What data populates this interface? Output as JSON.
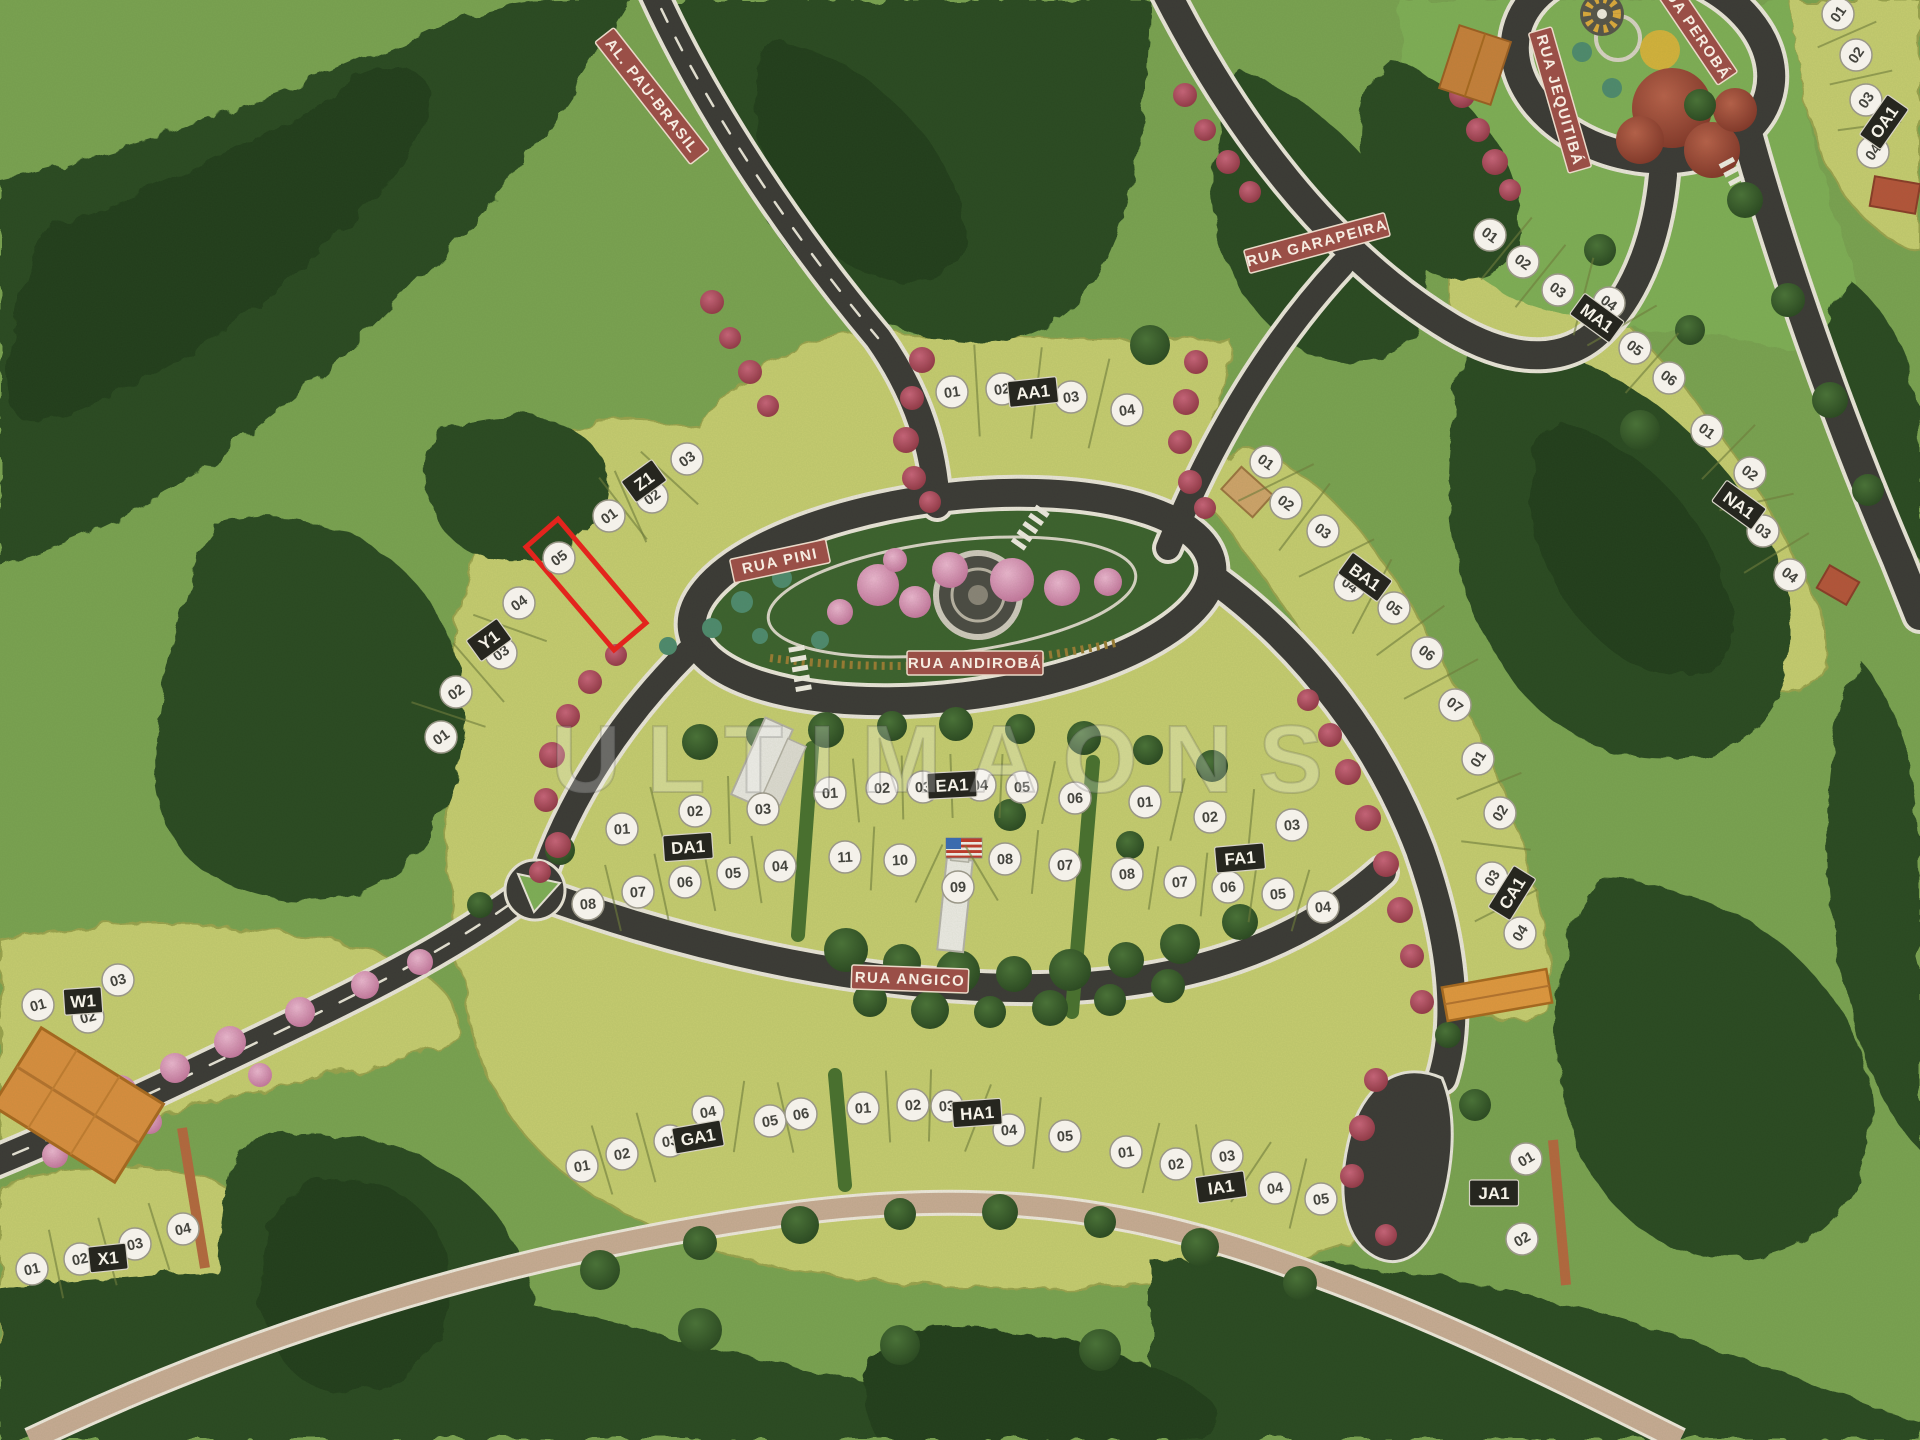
{
  "scene": {
    "description": "Aerial photograph of a physical scale model (maquette) of a residential land subdivision with forested terrain, named streets, numbered lots and one lot outlined in red",
    "width": 1920,
    "height": 1440
  },
  "watermark": {
    "text": "ULTIMAONS"
  },
  "palette": {
    "grass": "#7aa251",
    "lot_field": "#c6cc6f",
    "forest": "#2b4a22",
    "road": "#3b3936",
    "road_edge": "#eae5d9",
    "banner": "#9a4f47",
    "plaque": "#26261f",
    "badge": "#f4f1ea",
    "highlight": "#e3241d",
    "trail": "#c8ab94",
    "bougainvillea": "#b0475a",
    "pink_tree": "#d993b6",
    "autumn_tree": "#9c4433",
    "yellow_flower": "#d9ab3c"
  },
  "roads": [
    {
      "id": "al-pau-brasil",
      "label": "AL. PAU-BRASIL",
      "x": 652,
      "y": 96,
      "angle": 52
    },
    {
      "id": "rua-garapeira",
      "label": "RUA GARAPEIRA",
      "x": 1317,
      "y": 243,
      "angle": -15
    },
    {
      "id": "rua-jequitiba",
      "label": "RUA JEQUITIBÁ",
      "x": 1560,
      "y": 100,
      "angle": 74
    },
    {
      "id": "rua-peroba",
      "label": "RUA PEROBÁ",
      "x": 1695,
      "y": 30,
      "angle": 56
    },
    {
      "id": "rua-pini",
      "label": "RUA PINI",
      "x": 780,
      "y": 561,
      "angle": -12
    },
    {
      "id": "rua-andiroba",
      "label": "RUA ANDIROBÁ",
      "x": 975,
      "y": 663,
      "angle": 0
    },
    {
      "id": "rua-angico",
      "label": "RUA ANGICO",
      "x": 910,
      "y": 979,
      "angle": 2
    }
  ],
  "highlight": {
    "block": "Z1",
    "lot": "05",
    "points": "558,519 646,623 614,650 526,547"
  },
  "blocks": [
    {
      "label": "Z1",
      "plaque": {
        "x": 644,
        "y": 481,
        "angle": -36
      },
      "badge_angle": -36,
      "dividers": true,
      "divider_len": 78,
      "row_breaks": [],
      "lots": [
        {
          "n": "01",
          "x": 609,
          "y": 516
        },
        {
          "n": "02",
          "x": 652,
          "y": 497
        },
        {
          "n": "03",
          "x": 687,
          "y": 459
        },
        {
          "n": "05",
          "x": 559,
          "y": 558
        }
      ]
    },
    {
      "label": "Y1",
      "plaque": {
        "x": 489,
        "y": 640,
        "angle": -36
      },
      "badge_angle": -36,
      "dividers": true,
      "divider_len": 78,
      "row_breaks": [],
      "lots": [
        {
          "n": "01",
          "x": 441,
          "y": 737
        },
        {
          "n": "02",
          "x": 456,
          "y": 692
        },
        {
          "n": "03",
          "x": 501,
          "y": 653
        },
        {
          "n": "04",
          "x": 519,
          "y": 603
        }
      ]
    },
    {
      "label": "W1",
      "plaque": {
        "x": 83,
        "y": 1001,
        "angle": -4
      },
      "badge_angle": -15,
      "dividers": false,
      "divider_len": 60,
      "row_breaks": [],
      "lots": [
        {
          "n": "01",
          "x": 38,
          "y": 1005
        },
        {
          "n": "02",
          "x": 88,
          "y": 1017
        },
        {
          "n": "03",
          "x": 118,
          "y": 980
        }
      ]
    },
    {
      "label": "X1",
      "plaque": {
        "x": 108,
        "y": 1258,
        "angle": -6
      },
      "badge_angle": -12,
      "dividers": true,
      "divider_len": 70,
      "row_breaks": [],
      "lots": [
        {
          "n": "01",
          "x": 32,
          "y": 1269
        },
        {
          "n": "02",
          "x": 80,
          "y": 1259
        },
        {
          "n": "03",
          "x": 135,
          "y": 1244
        },
        {
          "n": "04",
          "x": 183,
          "y": 1229
        }
      ]
    },
    {
      "label": "AA1",
      "plaque": {
        "x": 1033,
        "y": 392,
        "angle": -6
      },
      "badge_angle": -8,
      "dividers": true,
      "divider_len": 92,
      "row_breaks": [],
      "lots": [
        {
          "n": "01",
          "x": 952,
          "y": 392
        },
        {
          "n": "02",
          "x": 1002,
          "y": 389
        },
        {
          "n": "03",
          "x": 1071,
          "y": 397
        },
        {
          "n": "04",
          "x": 1127,
          "y": 410
        }
      ]
    },
    {
      "label": "BA1",
      "plaque": {
        "x": 1365,
        "y": 577,
        "angle": 36
      },
      "badge_angle": 36,
      "dividers": true,
      "divider_len": 84,
      "row_breaks": [],
      "lots": [
        {
          "n": "01",
          "x": 1266,
          "y": 462
        },
        {
          "n": "02",
          "x": 1286,
          "y": 503
        },
        {
          "n": "03",
          "x": 1323,
          "y": 531
        },
        {
          "n": "04",
          "x": 1350,
          "y": 585
        },
        {
          "n": "05",
          "x": 1394,
          "y": 608
        },
        {
          "n": "06",
          "x": 1427,
          "y": 653
        },
        {
          "n": "07",
          "x": 1455,
          "y": 705
        }
      ]
    },
    {
      "label": "CA1",
      "plaque": {
        "x": 1512,
        "y": 893,
        "angle": -58
      },
      "badge_angle": -58,
      "dividers": true,
      "divider_len": 70,
      "row_breaks": [],
      "lots": [
        {
          "n": "01",
          "x": 1478,
          "y": 759
        },
        {
          "n": "02",
          "x": 1500,
          "y": 813
        },
        {
          "n": "03",
          "x": 1492,
          "y": 878
        },
        {
          "n": "04",
          "x": 1520,
          "y": 933
        }
      ]
    },
    {
      "label": "DA1",
      "plaque": {
        "x": 688,
        "y": 847,
        "angle": -4
      },
      "badge_angle": -4,
      "dividers": true,
      "divider_len": 68,
      "row_breaks": [
        3
      ],
      "lots": [
        {
          "n": "01",
          "x": 622,
          "y": 829
        },
        {
          "n": "02",
          "x": 695,
          "y": 811
        },
        {
          "n": "03",
          "x": 763,
          "y": 809
        },
        {
          "n": "04",
          "x": 780,
          "y": 866
        },
        {
          "n": "05",
          "x": 733,
          "y": 873
        },
        {
          "n": "06",
          "x": 685,
          "y": 882
        },
        {
          "n": "07",
          "x": 638,
          "y": 892
        },
        {
          "n": "08",
          "x": 588,
          "y": 904
        }
      ]
    },
    {
      "label": "EA1",
      "plaque": {
        "x": 952,
        "y": 785,
        "angle": -3
      },
      "badge_angle": -3,
      "dividers": true,
      "divider_len": 64,
      "row_breaks": [
        6
      ],
      "lots": [
        {
          "n": "01",
          "x": 830,
          "y": 793
        },
        {
          "n": "02",
          "x": 882,
          "y": 788
        },
        {
          "n": "03",
          "x": 923,
          "y": 787
        },
        {
          "n": "04",
          "x": 980,
          "y": 785
        },
        {
          "n": "05",
          "x": 1022,
          "y": 787
        },
        {
          "n": "06",
          "x": 1075,
          "y": 798
        },
        {
          "n": "07",
          "x": 1065,
          "y": 865
        },
        {
          "n": "08",
          "x": 1005,
          "y": 859
        },
        {
          "n": "09",
          "x": 958,
          "y": 887
        },
        {
          "n": "10",
          "x": 900,
          "y": 860
        },
        {
          "n": "11",
          "x": 845,
          "y": 857
        }
      ]
    },
    {
      "label": "FA1",
      "plaque": {
        "x": 1240,
        "y": 858,
        "angle": -5
      },
      "badge_angle": -5,
      "dividers": true,
      "divider_len": 64,
      "row_breaks": [
        3
      ],
      "lots": [
        {
          "n": "01",
          "x": 1145,
          "y": 802
        },
        {
          "n": "02",
          "x": 1210,
          "y": 817
        },
        {
          "n": "03",
          "x": 1292,
          "y": 825
        },
        {
          "n": "04",
          "x": 1323,
          "y": 907
        },
        {
          "n": "05",
          "x": 1278,
          "y": 894
        },
        {
          "n": "06",
          "x": 1228,
          "y": 887
        },
        {
          "n": "07",
          "x": 1180,
          "y": 882
        },
        {
          "n": "08",
          "x": 1127,
          "y": 874
        }
      ]
    },
    {
      "label": "GA1",
      "plaque": {
        "x": 698,
        "y": 1137,
        "angle": -10
      },
      "badge_angle": -10,
      "dividers": true,
      "divider_len": 72,
      "row_breaks": [
        3
      ],
      "lots": [
        {
          "n": "01",
          "x": 582,
          "y": 1166
        },
        {
          "n": "02",
          "x": 622,
          "y": 1154
        },
        {
          "n": "03",
          "x": 670,
          "y": 1141
        },
        {
          "n": "04",
          "x": 708,
          "y": 1112
        },
        {
          "n": "05",
          "x": 770,
          "y": 1121
        },
        {
          "n": "06",
          "x": 801,
          "y": 1114
        }
      ]
    },
    {
      "label": "HA1",
      "plaque": {
        "x": 977,
        "y": 1113,
        "angle": -4
      },
      "badge_angle": -4,
      "dividers": true,
      "divider_len": 72,
      "row_breaks": [],
      "lots": [
        {
          "n": "01",
          "x": 863,
          "y": 1108
        },
        {
          "n": "02",
          "x": 913,
          "y": 1105
        },
        {
          "n": "03",
          "x": 947,
          "y": 1106
        },
        {
          "n": "04",
          "x": 1009,
          "y": 1130
        },
        {
          "n": "05",
          "x": 1065,
          "y": 1136
        }
      ]
    },
    {
      "label": "IA1",
      "plaque": {
        "x": 1221,
        "y": 1187,
        "angle": -8
      },
      "badge_angle": -8,
      "dividers": true,
      "divider_len": 72,
      "row_breaks": [],
      "lots": [
        {
          "n": "01",
          "x": 1126,
          "y": 1152
        },
        {
          "n": "02",
          "x": 1176,
          "y": 1164
        },
        {
          "n": "03",
          "x": 1227,
          "y": 1156
        },
        {
          "n": "04",
          "x": 1275,
          "y": 1188
        },
        {
          "n": "05",
          "x": 1321,
          "y": 1199
        }
      ]
    },
    {
      "label": "JA1",
      "plaque": {
        "x": 1494,
        "y": 1193,
        "angle": 0
      },
      "badge_angle": -30,
      "dividers": false,
      "divider_len": 60,
      "row_breaks": [],
      "lots": [
        {
          "n": "01",
          "x": 1526,
          "y": 1159
        },
        {
          "n": "02",
          "x": 1522,
          "y": 1239
        }
      ]
    },
    {
      "label": "MA1",
      "plaque": {
        "x": 1597,
        "y": 318,
        "angle": 36
      },
      "badge_angle": 36,
      "dividers": true,
      "divider_len": 80,
      "row_breaks": [],
      "lots": [
        {
          "n": "01",
          "x": 1490,
          "y": 235
        },
        {
          "n": "02",
          "x": 1523,
          "y": 262
        },
        {
          "n": "03",
          "x": 1558,
          "y": 290
        },
        {
          "n": "04",
          "x": 1609,
          "y": 303
        },
        {
          "n": "05",
          "x": 1635,
          "y": 348
        },
        {
          "n": "06",
          "x": 1669,
          "y": 378
        }
      ]
    },
    {
      "label": "NA1",
      "plaque": {
        "x": 1739,
        "y": 505,
        "angle": 36
      },
      "badge_angle": 36,
      "dividers": true,
      "divider_len": 76,
      "row_breaks": [],
      "lots": [
        {
          "n": "01",
          "x": 1707,
          "y": 431
        },
        {
          "n": "02",
          "x": 1750,
          "y": 473
        },
        {
          "n": "03",
          "x": 1763,
          "y": 531
        },
        {
          "n": "04",
          "x": 1790,
          "y": 575
        }
      ]
    },
    {
      "label": "OA1",
      "plaque": {
        "x": 1884,
        "y": 122,
        "angle": -55
      },
      "badge_angle": -55,
      "dividers": true,
      "divider_len": 64,
      "row_breaks": [],
      "lots": [
        {
          "n": "01",
          "x": 1838,
          "y": 14
        },
        {
          "n": "02",
          "x": 1856,
          "y": 55
        },
        {
          "n": "03",
          "x": 1866,
          "y": 100
        },
        {
          "n": "04",
          "x": 1873,
          "y": 152
        }
      ]
    }
  ]
}
